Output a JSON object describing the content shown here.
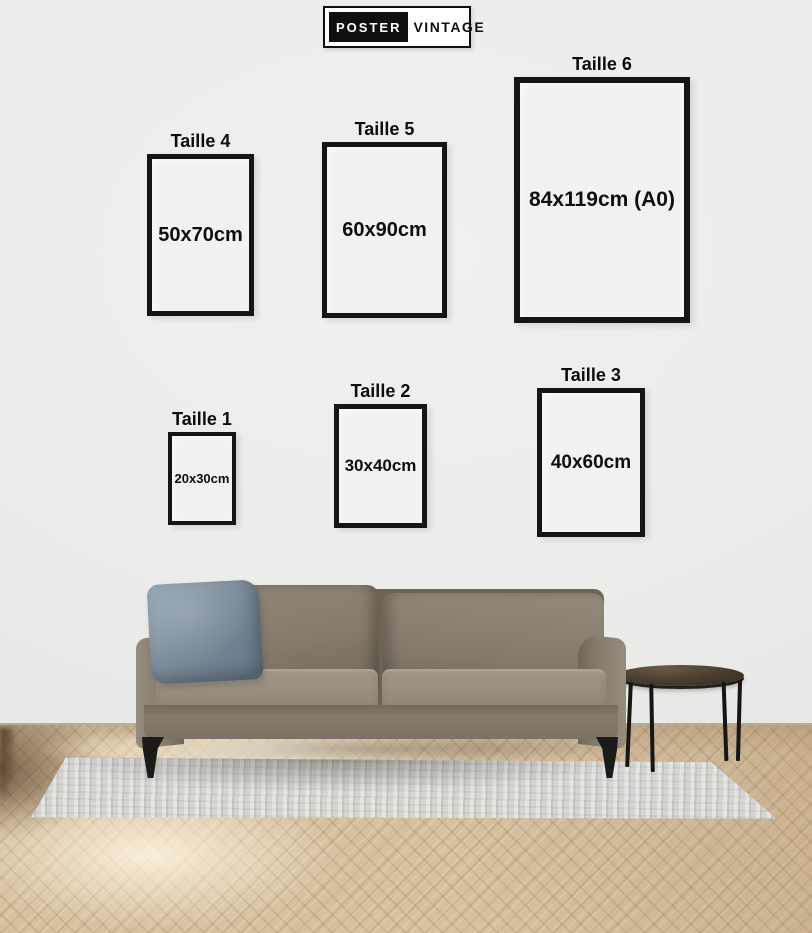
{
  "logo": {
    "left": "POSTER",
    "right": "VINTAGE"
  },
  "sizes": [
    {
      "label": "Taille 4",
      "dimension": "50x70cm"
    },
    {
      "label": "Taille 5",
      "dimension": "60x90cm"
    },
    {
      "label": "Taille 6",
      "dimension": "84x119cm (A0)"
    },
    {
      "label": "Taille 1",
      "dimension": "20x30cm"
    },
    {
      "label": "Taille 2",
      "dimension": "30x40cm"
    },
    {
      "label": "Taille 3",
      "dimension": "40x60cm"
    }
  ],
  "scene": {
    "furniture": [
      "sofa",
      "pillow",
      "side-table",
      "rug"
    ],
    "colors": {
      "wall": "#ececec",
      "frame_border": "#151515",
      "frame_interior": "#f1f1ef",
      "text": "#0d0d0d",
      "logo_black": "#101010",
      "sofa": "#8c8173",
      "pillow_blue": "#7d8c9b",
      "floor_wood": "#d6c0a0",
      "rug": "#d9d9d7",
      "legs": "#1b1b1b"
    }
  }
}
